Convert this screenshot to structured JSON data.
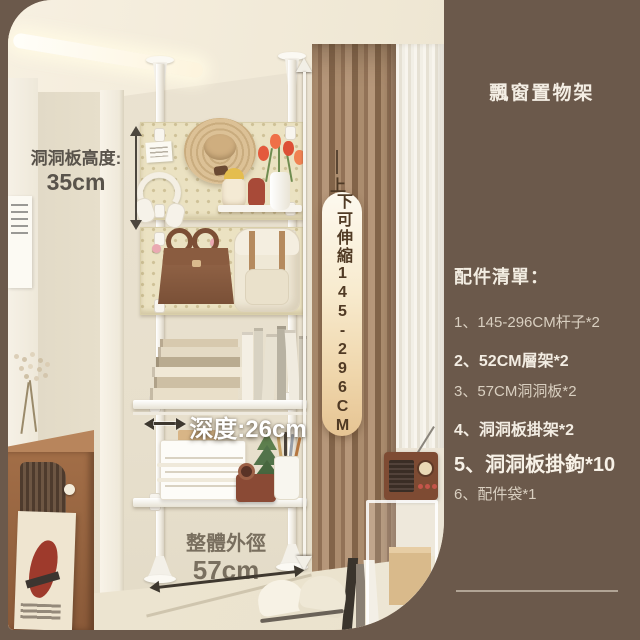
{
  "title": "飄窗置物架",
  "annotations": {
    "pegboard_height": {
      "label": "洞洞板高度:",
      "value": "35cm"
    },
    "extension": {
      "prefix": "上",
      "text": "下可伸縮145-296CM"
    },
    "depth": "深度:26cm",
    "overall_width": {
      "label": "整體外徑",
      "value": "57cm"
    }
  },
  "accessories": {
    "header": "配件清單：",
    "items": [
      {
        "text": "1、145-296CM杆子*2",
        "style": "normal"
      },
      {
        "text": "2、52CM層架*2",
        "style": "bold"
      },
      {
        "text": "3、57CM洞洞板*2",
        "style": "normal"
      },
      {
        "text": "4、洞洞板掛架*2",
        "style": "bold"
      },
      {
        "text": "5、洞洞板掛鉤*10",
        "style": "large"
      },
      {
        "text": "6、配件袋*1",
        "style": "normal"
      }
    ]
  },
  "colors": {
    "panel_brown": "#6b594b",
    "banner_text": "#503a24",
    "banner_gradient_top": "#fdf9ef",
    "banner_gradient_bottom": "#e6c493",
    "list_text_bright": "#f3ede3",
    "list_text_dim": "#d9cfc0",
    "measure_white": "#f7f4ec",
    "measure_dark": "#46403a",
    "pegboard": "#ebe2c2",
    "curtain": "#a98a6c"
  }
}
